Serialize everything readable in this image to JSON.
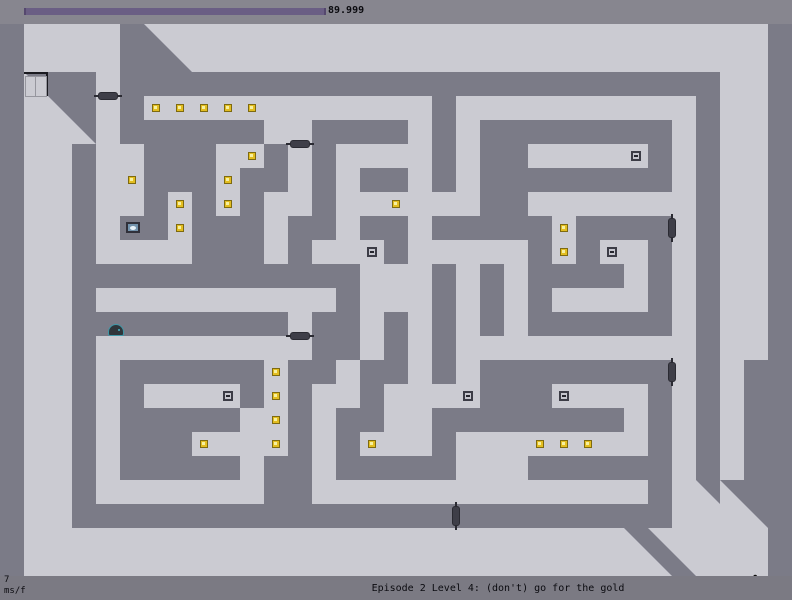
{
  "hud_top": {
    "timer_value": "89.999",
    "bar": {
      "x": 24,
      "y": 8,
      "width": 298,
      "height": 7
    }
  },
  "hud_bottom": {
    "frame_time_value": "7",
    "frame_time_unit": "ms/f",
    "level_title": "Episode 2 Level 4: (don't) go for the gold"
  },
  "colors": {
    "floor": "#cbcbd2",
    "wall": "#7b7b87",
    "hud_top_bg": "#87868f",
    "hud_bottom_bg": "#7b7a83",
    "timer_fill": "#6a5e84",
    "timer_cap": "#55486e",
    "gold_body": "#e3bd20",
    "gold_highlight": "#f7f0a0",
    "mine_frame": "#3c3c46",
    "mine_inner": "#c6c6ce",
    "mine_dot": "#26262e",
    "door_line": "#2a2a32",
    "door_pill": "#3e3e48",
    "exit_frame": "#1a1a20",
    "exit_panel_border": "#96969e",
    "switch_frame": "#30303a",
    "switch_bg": "#7292ac",
    "switch_oval": "#e8f2f8",
    "guard_body": "#2f363b",
    "guard_outline": "#3f98a8",
    "ninja_color": "#0d0d0d"
  },
  "level": {
    "tile_size": 24,
    "origin_y": 24,
    "grid_rows": [
      "#....#z.........................#",
      "#....##z........................#",
      "#e##.#########################..#",
      "#.e#.#............#..........#..#",
      "#..e.######..####.#.########.#..#",
      "#..#..###..#.#....#.##.....#.#..#",
      "#..#..###.##.#.##.#.########.#..#",
      "#..#..#.#.#..#......##.......#..#",
      "#..#.##.###.##.##.#####.####.#..#",
      "#..#....###.#...#.....#.#..#.#..#",
      "#..############...#.#.####.#.#..#",
      "#..#..........#...#.#.#....#.#..#",
      "#..#########.##.#.#.#.######.#..#",
      "#..#.........##.#.#..........#..#",
      "#..#.######.##.##.#.########.#.##",
      "#..#.#....#.#..#....###....#.#.##",
      "#..#.#####..#.##..########.#.#.##",
      "#..#.###....#.#...#........#.#.##",
      "#..#.#####.##.#####...######.#.##",
      "#..#.......##..............#.ee##",
      "#..#########################...e#",
      "#.........................ez....#",
      "#..........................ez...#"
    ],
    "golds": [
      [
        6,
        3
      ],
      [
        7,
        3
      ],
      [
        8,
        3
      ],
      [
        9,
        3
      ],
      [
        10,
        3
      ],
      [
        10,
        5
      ],
      [
        5,
        6
      ],
      [
        9,
        6
      ],
      [
        7,
        7
      ],
      [
        9,
        7
      ],
      [
        16,
        7
      ],
      [
        7,
        8
      ],
      [
        23,
        8
      ],
      [
        23,
        9
      ],
      [
        11,
        14
      ],
      [
        11,
        15
      ],
      [
        11,
        16
      ],
      [
        11,
        17
      ],
      [
        8,
        17
      ],
      [
        15,
        17
      ],
      [
        22,
        17
      ],
      [
        23,
        17
      ],
      [
        24,
        17
      ]
    ],
    "mines": [
      [
        26,
        5
      ],
      [
        15,
        9
      ],
      [
        25,
        9
      ],
      [
        9,
        15
      ],
      [
        19,
        15
      ],
      [
        23,
        15
      ]
    ],
    "doors": [
      {
        "orientation": "h",
        "x": 96,
        "y": 72
      },
      {
        "orientation": "h",
        "x": 288,
        "y": 120
      },
      {
        "orientation": "h",
        "x": 288,
        "y": 312
      },
      {
        "orientation": "v",
        "x": 672,
        "y": 192
      },
      {
        "orientation": "v",
        "x": 672,
        "y": 336
      },
      {
        "orientation": "v",
        "x": 456,
        "y": 480
      }
    ],
    "exit_door": {
      "x": 24,
      "y": 48,
      "size": 24
    },
    "exit_switch": {
      "x": 126,
      "y": 198,
      "width": 14,
      "height": 11
    },
    "floor_guard": {
      "x": 108,
      "y": 300,
      "width": 16,
      "height": 12
    },
    "ninja": {
      "x": 747,
      "y": 550,
      "width": 15,
      "height": 23
    }
  }
}
